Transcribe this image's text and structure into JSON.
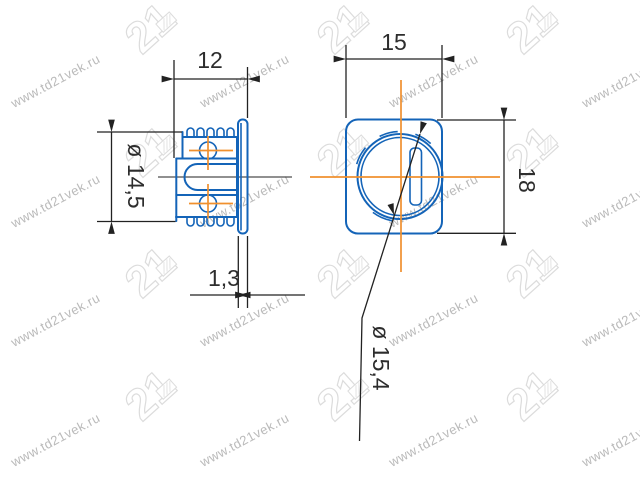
{
  "drawing": {
    "side_view": {
      "depth": "12",
      "body_diameter": "ø 14,5",
      "flange_thickness": "1,3"
    },
    "front_view": {
      "width": "15",
      "height": "18",
      "cam_diameter": "ø 15,4"
    }
  },
  "watermark": {
    "text": "www.td21vek.ru",
    "logo_text": "21"
  },
  "colors": {
    "background": "#ffffff",
    "part_outline": "#1464b8",
    "centerline": "#f0902e",
    "dimension_lines": "#222222",
    "watermark_text": "#bababa",
    "watermark_logo": "#dcdcdc"
  }
}
